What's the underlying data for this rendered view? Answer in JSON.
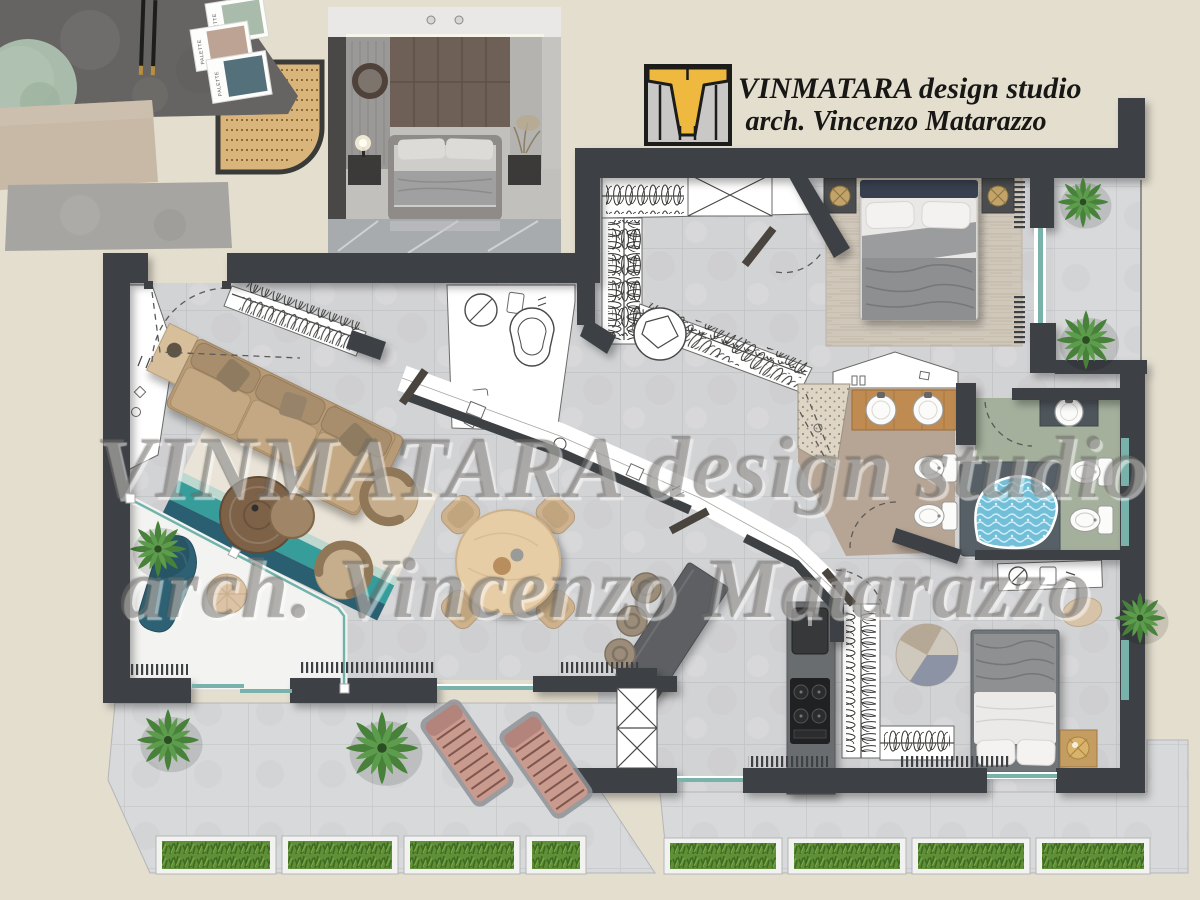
{
  "header": {
    "studio_line": "VINMATARA design studio",
    "architect_line": "arch. Vincenzo Matarazzo"
  },
  "watermark": {
    "line1": "VINMATARA design studio",
    "line2": "arch. Vincenzo Matarazzo"
  },
  "moodboard": {
    "palette_card_label": "PALETTE",
    "swatches": [
      "#a9bcab",
      "#bda394",
      "#53707b"
    ]
  },
  "colors": {
    "background": "#e4decf",
    "wall": "#3e4144",
    "floor_tile": "#d2d3d5",
    "terrace_tile": "#d8d9da",
    "window_glass": "#79b2aa",
    "bath_tan_floor": "#b6a595",
    "bath_sage_floor": "#a4b09c",
    "vanity_wood": "#c08b50",
    "tub_water": "#74bfd8",
    "sofa_tan": "#b79b77",
    "rug_teal": "#379d9a",
    "chaise_teal": "#2d6173",
    "dining_wood": "#e7cda6",
    "island_gray": "#5d5f62",
    "plant_green": "#47813a",
    "hedge_green": "#5f8f36",
    "lounger_pink": "#c99a8e",
    "logo_yellow": "#efb93f",
    "logo_gray": "#c9c8c6"
  }
}
